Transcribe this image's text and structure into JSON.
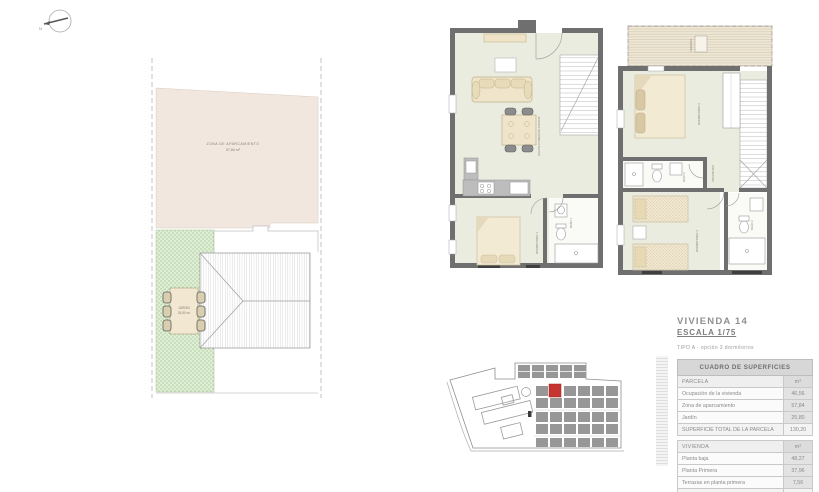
{
  "compass": {
    "label": "N"
  },
  "site_plan": {
    "parking_label": "ZONA DE APARCAMIENTO",
    "parking_area": "57,84 m²",
    "garden_label": "JARDÍN",
    "garden_area": "25,80 m²"
  },
  "ground_floor": {
    "living_label": "SALÓN-COMEDOR-COCINA",
    "bedroom1_label": "DORMITORIO 1",
    "bath1_label": "BAÑO 1"
  },
  "first_floor": {
    "terrace_label": "TERRAZA",
    "bedroom2_label": "DORMITORIO 2",
    "bedroom3_label": "DORMITORIO 3",
    "bath2_label": "BAÑO 2",
    "bath3_label": "BAÑO 3",
    "hall_label": "DISTRIBUIDOR"
  },
  "info": {
    "title": "VIVIENDA 14",
    "scale": "ESCALA 1/75",
    "subtitle": "TIPO A - opción 3 dormitorios"
  },
  "table": {
    "header": "CUADRO DE SUPERFICIES",
    "sections": [
      {
        "name": "PARCELA",
        "unit": "m²",
        "rows": [
          {
            "label": "Ocupación de la vivienda",
            "value": "46,56"
          },
          {
            "label": "Zona de aparcamiento",
            "value": "57,84"
          },
          {
            "label": "Jardín",
            "value": "25,80"
          }
        ],
        "total": {
          "label": "SUPERFICIE TOTAL DE LA PARCELA",
          "value": "130,20"
        }
      },
      {
        "name": "VIVIENDA",
        "unit": "m²",
        "rows": [
          {
            "label": "Planta baja",
            "value": "48,27"
          },
          {
            "label": "Planta Primera",
            "value": "37,96"
          },
          {
            "label": "Terrazas en planta primera",
            "value": "7,56"
          }
        ],
        "total": {
          "label": "SUPERFICIE TOTAL DE LA VIVIENDA",
          "value": "92,41"
        }
      }
    ]
  },
  "colors": {
    "highlight_red": "#c53430",
    "parking_beige": "#f1e7df",
    "garden_green": "#dfeed6",
    "floor_green": "#e9ecdf",
    "wall_gray": "#6f6f6f"
  }
}
